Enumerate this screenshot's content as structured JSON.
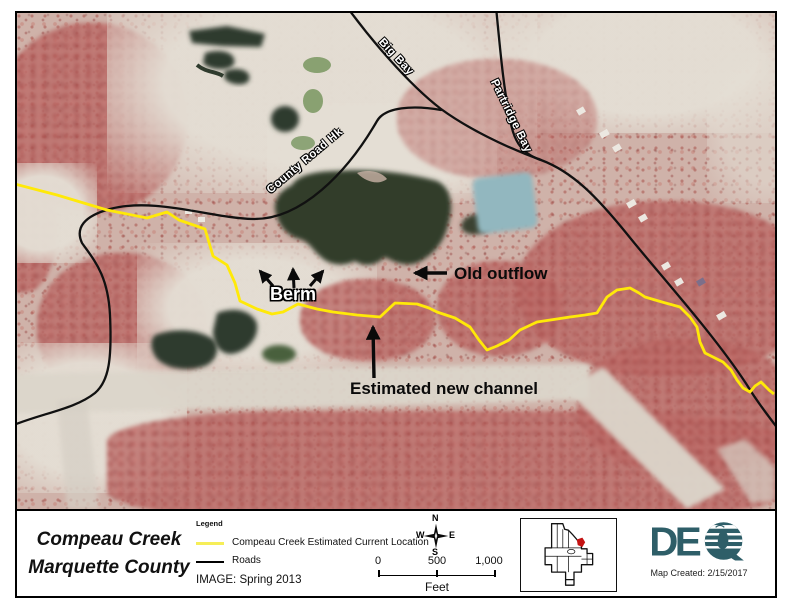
{
  "map": {
    "road_labels": [
      {
        "text": "Big Bay"
      },
      {
        "text": "Partridge Bay"
      },
      {
        "text": "County Road Hk"
      }
    ],
    "annotations": [
      {
        "text": "Berm"
      },
      {
        "text": "Old outflow"
      },
      {
        "text": "Estimated new channel"
      }
    ],
    "creek_color": "#ffe908",
    "road_color": "#111111",
    "teal_pond_color": "#92b7bf",
    "dark_pond_color": "#333d2b"
  },
  "info_bar": {
    "title": {
      "line1": "Compeau Creek",
      "line2": "Marquette County"
    },
    "legend": {
      "header": "Legend",
      "items": [
        {
          "label": "Compeau Creek Estimated Current Location",
          "swatch_color": "#f6ee58"
        },
        {
          "label": "Roads",
          "swatch_color": "#000000"
        }
      ],
      "image_note": "IMAGE: Spring 2013"
    },
    "compass": {
      "n": "N",
      "e": "E",
      "s": "S",
      "w": "W"
    },
    "scale_bar": {
      "tick_labels": [
        "0",
        "500",
        "1,000"
      ],
      "unit_label": "Feet"
    },
    "inset": {
      "marker_color": "#c41212"
    },
    "logo": {
      "name": "DEQ",
      "letters_de": "DE",
      "caption": "Map Created: 2/15/2017",
      "color": "#2e5e68"
    }
  }
}
